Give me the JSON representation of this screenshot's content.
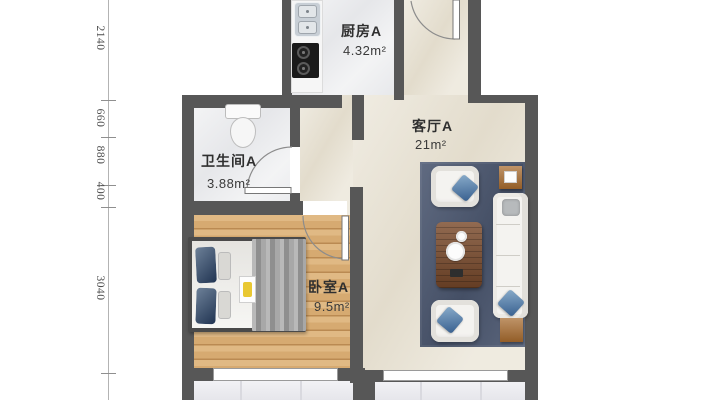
{
  "floorplan": {
    "rooms": {
      "kitchen": {
        "label": "厨房A",
        "area": "4.32m²"
      },
      "living": {
        "label": "客厅A",
        "area": "21m²"
      },
      "bathroom": {
        "label": "卫生间A",
        "area": "3.88m²"
      },
      "bedroom": {
        "label": "卧室A",
        "area": "9.5m²"
      }
    },
    "dimensions": [
      "2140",
      "660",
      "880",
      "400",
      "3040"
    ],
    "colors": {
      "wall": "#575757",
      "tile_floor": "#ebecee",
      "beige_floor": "#e8e2d3",
      "wood_floor": "#d6aa71",
      "balcony_floor": "#ececf0",
      "rug": "#4e5a73",
      "pillow_accent": "#4a7fae",
      "wood_furniture": "#a96f35"
    }
  }
}
